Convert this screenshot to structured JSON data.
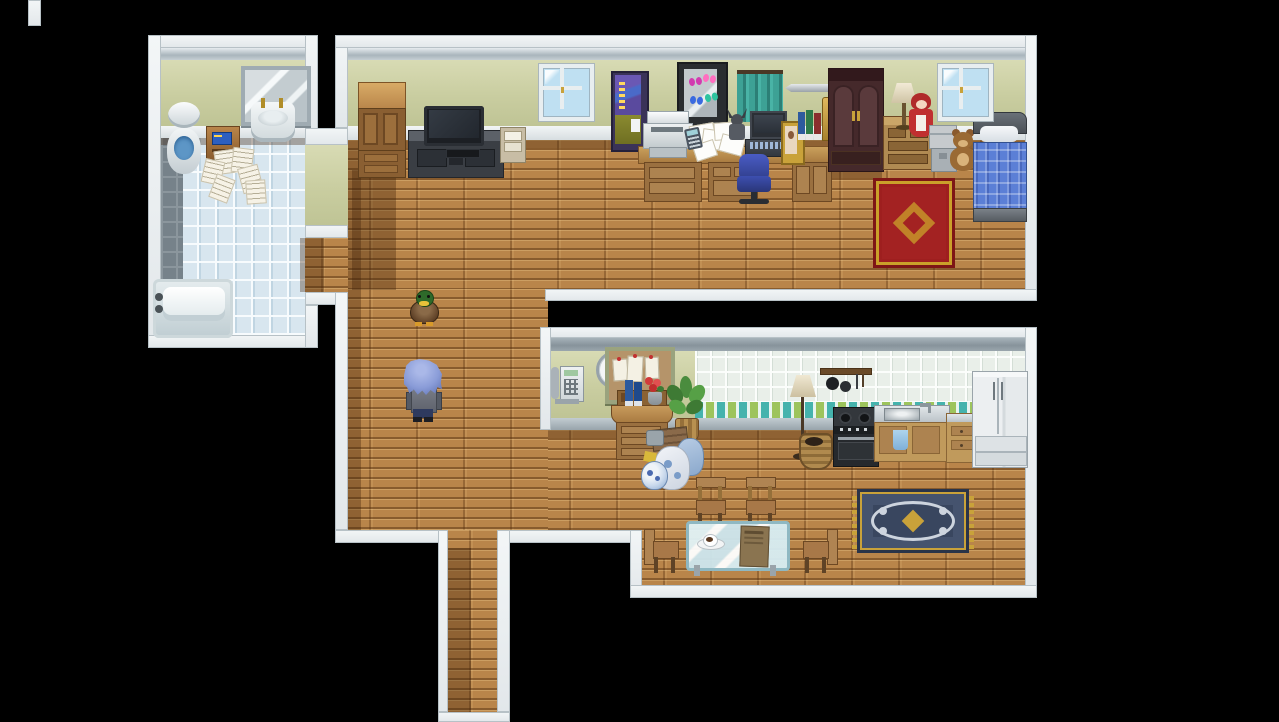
{
  "game": {
    "view": "Top-down apartment interior map",
    "style": "16-bit RPG tilemap on black void",
    "background_color": "#000000"
  },
  "palette": {
    "void": "#000000",
    "wall_top_white": "#eef2f3",
    "wall_green": "#cccfa2",
    "wall_trim_gray": "#a9b5bc",
    "floor_wood": "#b9854a",
    "bathroom_tile": "#d8e6ef",
    "bathroom_gray_tile": "#76828a",
    "kitchen_tile": "#e9efe9",
    "accent_tile_teal": "#45b3ad",
    "accent_tile_green": "#9dc45c",
    "bed_blanket_blue": "#5b7fd6",
    "rug_red": "#a32222",
    "rug_navy": "#39465f",
    "rug_gold": "#c9a23a",
    "chair_blue": "#3949ab",
    "curtain_teal": "#3da195"
  },
  "rooms": {
    "bathroom": {
      "label": "Bathroom",
      "items": [
        "wall-mirror",
        "wash-sink",
        "toilet",
        "wooden-scale-device",
        "scattered-papers",
        "bathtub",
        "blue-tile-floor",
        "gray-tile-strip"
      ]
    },
    "main_room": {
      "label": "Bedroom / Study",
      "items": [
        "light-wardrobe",
        "tv",
        "tv-stand",
        "game-console",
        "magazine-rack",
        "window-left",
        "wall-poster",
        "butterfly-display-case",
        "teal-curtain",
        "mounted-sword",
        "printer",
        "long-desk",
        "desk-papers",
        "calculator",
        "figurine",
        "laptop",
        "photo-frame",
        "desk-books",
        "gold-bookend",
        "office-chair",
        "dark-armoire",
        "dresser",
        "table-lamp",
        "red-doll",
        "storage-boxes",
        "teddy-bear",
        "bed",
        "red-rug",
        "window-right"
      ]
    },
    "hallway": {
      "label": "Hallway",
      "items": [
        "wood-floor",
        "doorway-to-bathroom",
        "south-corridor"
      ]
    },
    "kitchen_dining": {
      "label": "Kitchen & Dining Room",
      "items": [
        "wall-clock",
        "wall-phone",
        "corkboard-notes",
        "writing-cabinet",
        "cabinet-books",
        "flower-vase",
        "potted-plant",
        "trash-bags",
        "blue-vase",
        "floor-lamp",
        "hanging-pot-rack",
        "basket",
        "stove",
        "sink-counter",
        "drawer-counter",
        "refrigerator",
        "dining-chair-north-1",
        "dining-chair-north-2",
        "dining-chair-west",
        "dining-chair-east",
        "glass-table",
        "coffee-cup",
        "menu-book",
        "navy-rug",
        "tile-backsplash"
      ]
    }
  },
  "characters": {
    "player": {
      "label": "Player character (blue spiky hair, seen from behind, facing up)",
      "facing": "up",
      "hair_color": "#93a7dc",
      "shirt_color": "#6a6e78"
    },
    "duck": {
      "label": "Mallard duck NPC (facing down)",
      "facing": "down",
      "head_color": "#2e6a2a",
      "body_color": "#6a4a30"
    }
  }
}
